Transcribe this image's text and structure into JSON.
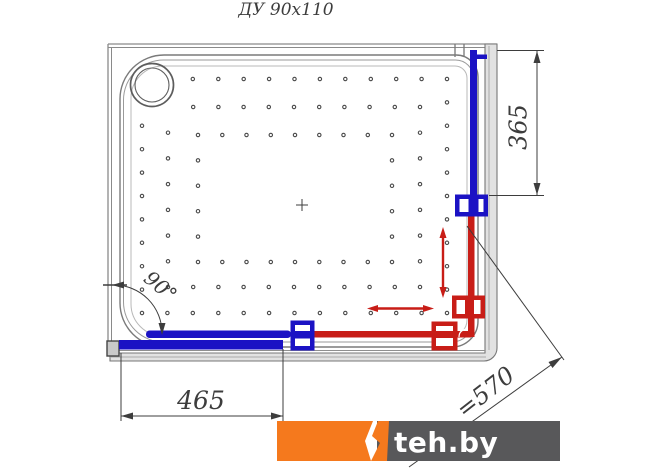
{
  "title": "ДУ 90x110",
  "dimensions": {
    "side_offset": "365",
    "bottom_width": "465",
    "diagonal": "=570",
    "corner_angle": "90°"
  },
  "logo": {
    "text": "teh.by",
    "orange": "#f5791d",
    "dark": "#58585a"
  },
  "colors": {
    "cold_water": "#1b12c4",
    "hot_water": "#c81d17",
    "frame": "#8a8a8a",
    "dimension": "#3d3d3d"
  },
  "drawing": {
    "dot_spacing": 24.5,
    "dot_radius": 1.7,
    "dot_color": "#4a4a4a",
    "drain_center": {
      "x": 152,
      "y": 85
    },
    "drain_skip_radius": 40,
    "dot_rings": [
      {
        "x1": 142,
        "y1": 79,
        "x2": 447,
        "y2": 313
      },
      {
        "x1": 168,
        "y1": 107,
        "x2": 420,
        "y2": 287
      },
      {
        "x1": 198,
        "y1": 135,
        "x2": 392,
        "y2": 262
      }
    ]
  }
}
